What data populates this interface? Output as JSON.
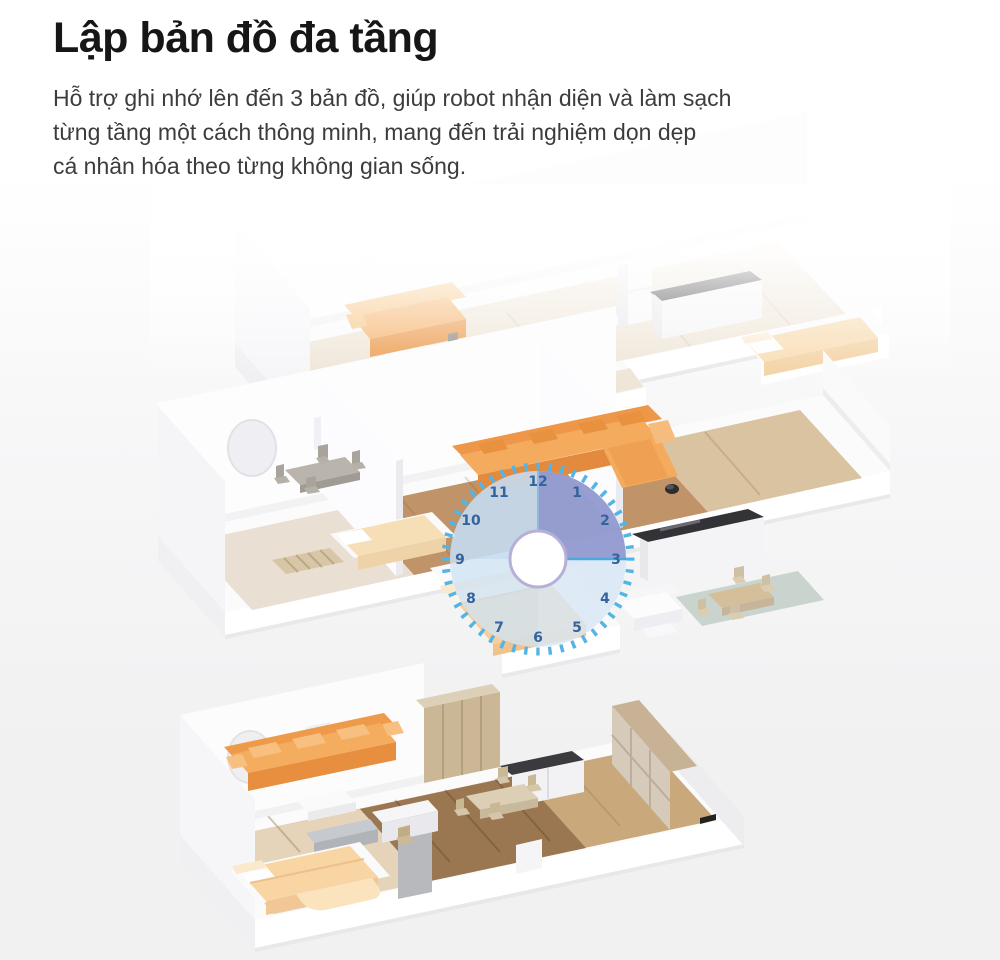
{
  "header": {
    "title": "Lập bản đồ đa tầng",
    "description_lines": [
      "Hỗ trợ ghi nhớ lên đến 3 bản đồ, giúp robot nhận diện và làm sạch",
      "từng tầng một cách thông minh, mang đến trải nghiệm dọn dẹp",
      "cá nhân hóa theo từng không gian sống."
    ]
  },
  "illustration": {
    "description": "Isometric cutaway of three stacked apartment floor plans, top floor fading to white, with a translucent cleaning-schedule clock dial overlaid; the 12-to-3 sector is highlighted",
    "floor_count_shown": 3,
    "clock": {
      "numbers": [
        "12",
        "1",
        "2",
        "3",
        "4",
        "5",
        "6",
        "7",
        "8",
        "9",
        "10",
        "11"
      ],
      "highlighted_sector": "12-3"
    }
  },
  "palette": {
    "clock_tick_blue": "#54b4e4",
    "clock_disc_blue": "#cfe3f3",
    "clock_highlight": "#8d94cd",
    "clock_number_blue": "#34639e",
    "hub_ring": "#b6b0d8",
    "sofa_orange": "#f4ab5e",
    "bed_peach": "#f7cf9e",
    "wood_dark": "#9a7751",
    "wood_light": "#e9dfd2",
    "background_bottom": "#f1f1f2",
    "text_dark": "#161616"
  }
}
